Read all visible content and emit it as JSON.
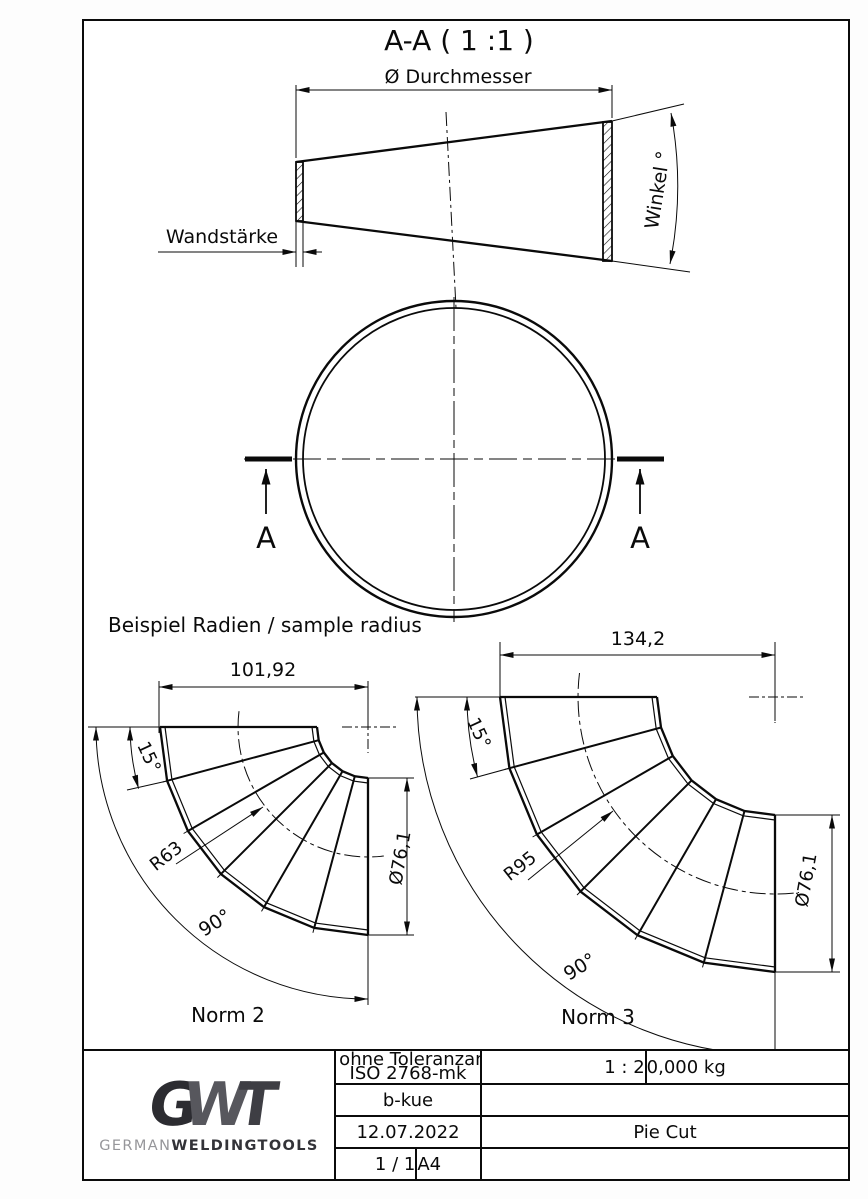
{
  "drawing": {
    "title": "A-A ( 1 :1 )",
    "cone": {
      "diameter_label": "Ø Durchmesser",
      "wall_label": "Wandstärke",
      "angle_label": "Winkel °"
    },
    "section_marks": {
      "left": "A",
      "right": "A"
    },
    "samples_heading": "Beispiel Radien / sample radius",
    "norm2": {
      "name": "Norm 2",
      "width": "101,92",
      "segment_angle": "15°",
      "bend_radius": "R63",
      "sweep_angle": "90°",
      "tube_diameter": "Ø76,1"
    },
    "norm3": {
      "name": "Norm 3",
      "width": "134,2",
      "segment_angle": "15°",
      "bend_radius": "R95",
      "sweep_angle": "90°",
      "tube_diameter": "Ø76,1"
    }
  },
  "title_block": {
    "tolerance_line1": "Maße ohne Toleranzangabe",
    "tolerance_line2": "ISO 2768-mk",
    "created_by": "b-kue",
    "date": "12.07.2022",
    "sheet": "1 / 1",
    "paper_format": "A4",
    "scale": "1 : 2",
    "weight": "0,000 kg",
    "part_title": "Pie Cut",
    "logo": {
      "letter_g": "G",
      "letter_w": "W",
      "letter_t": "T",
      "word_light": "GERMAN",
      "word_bold": "WELDINGTOOLS",
      "color_dark": "#2c2c31",
      "color_mid": "#57575d",
      "color_light": "#96969a"
    }
  }
}
